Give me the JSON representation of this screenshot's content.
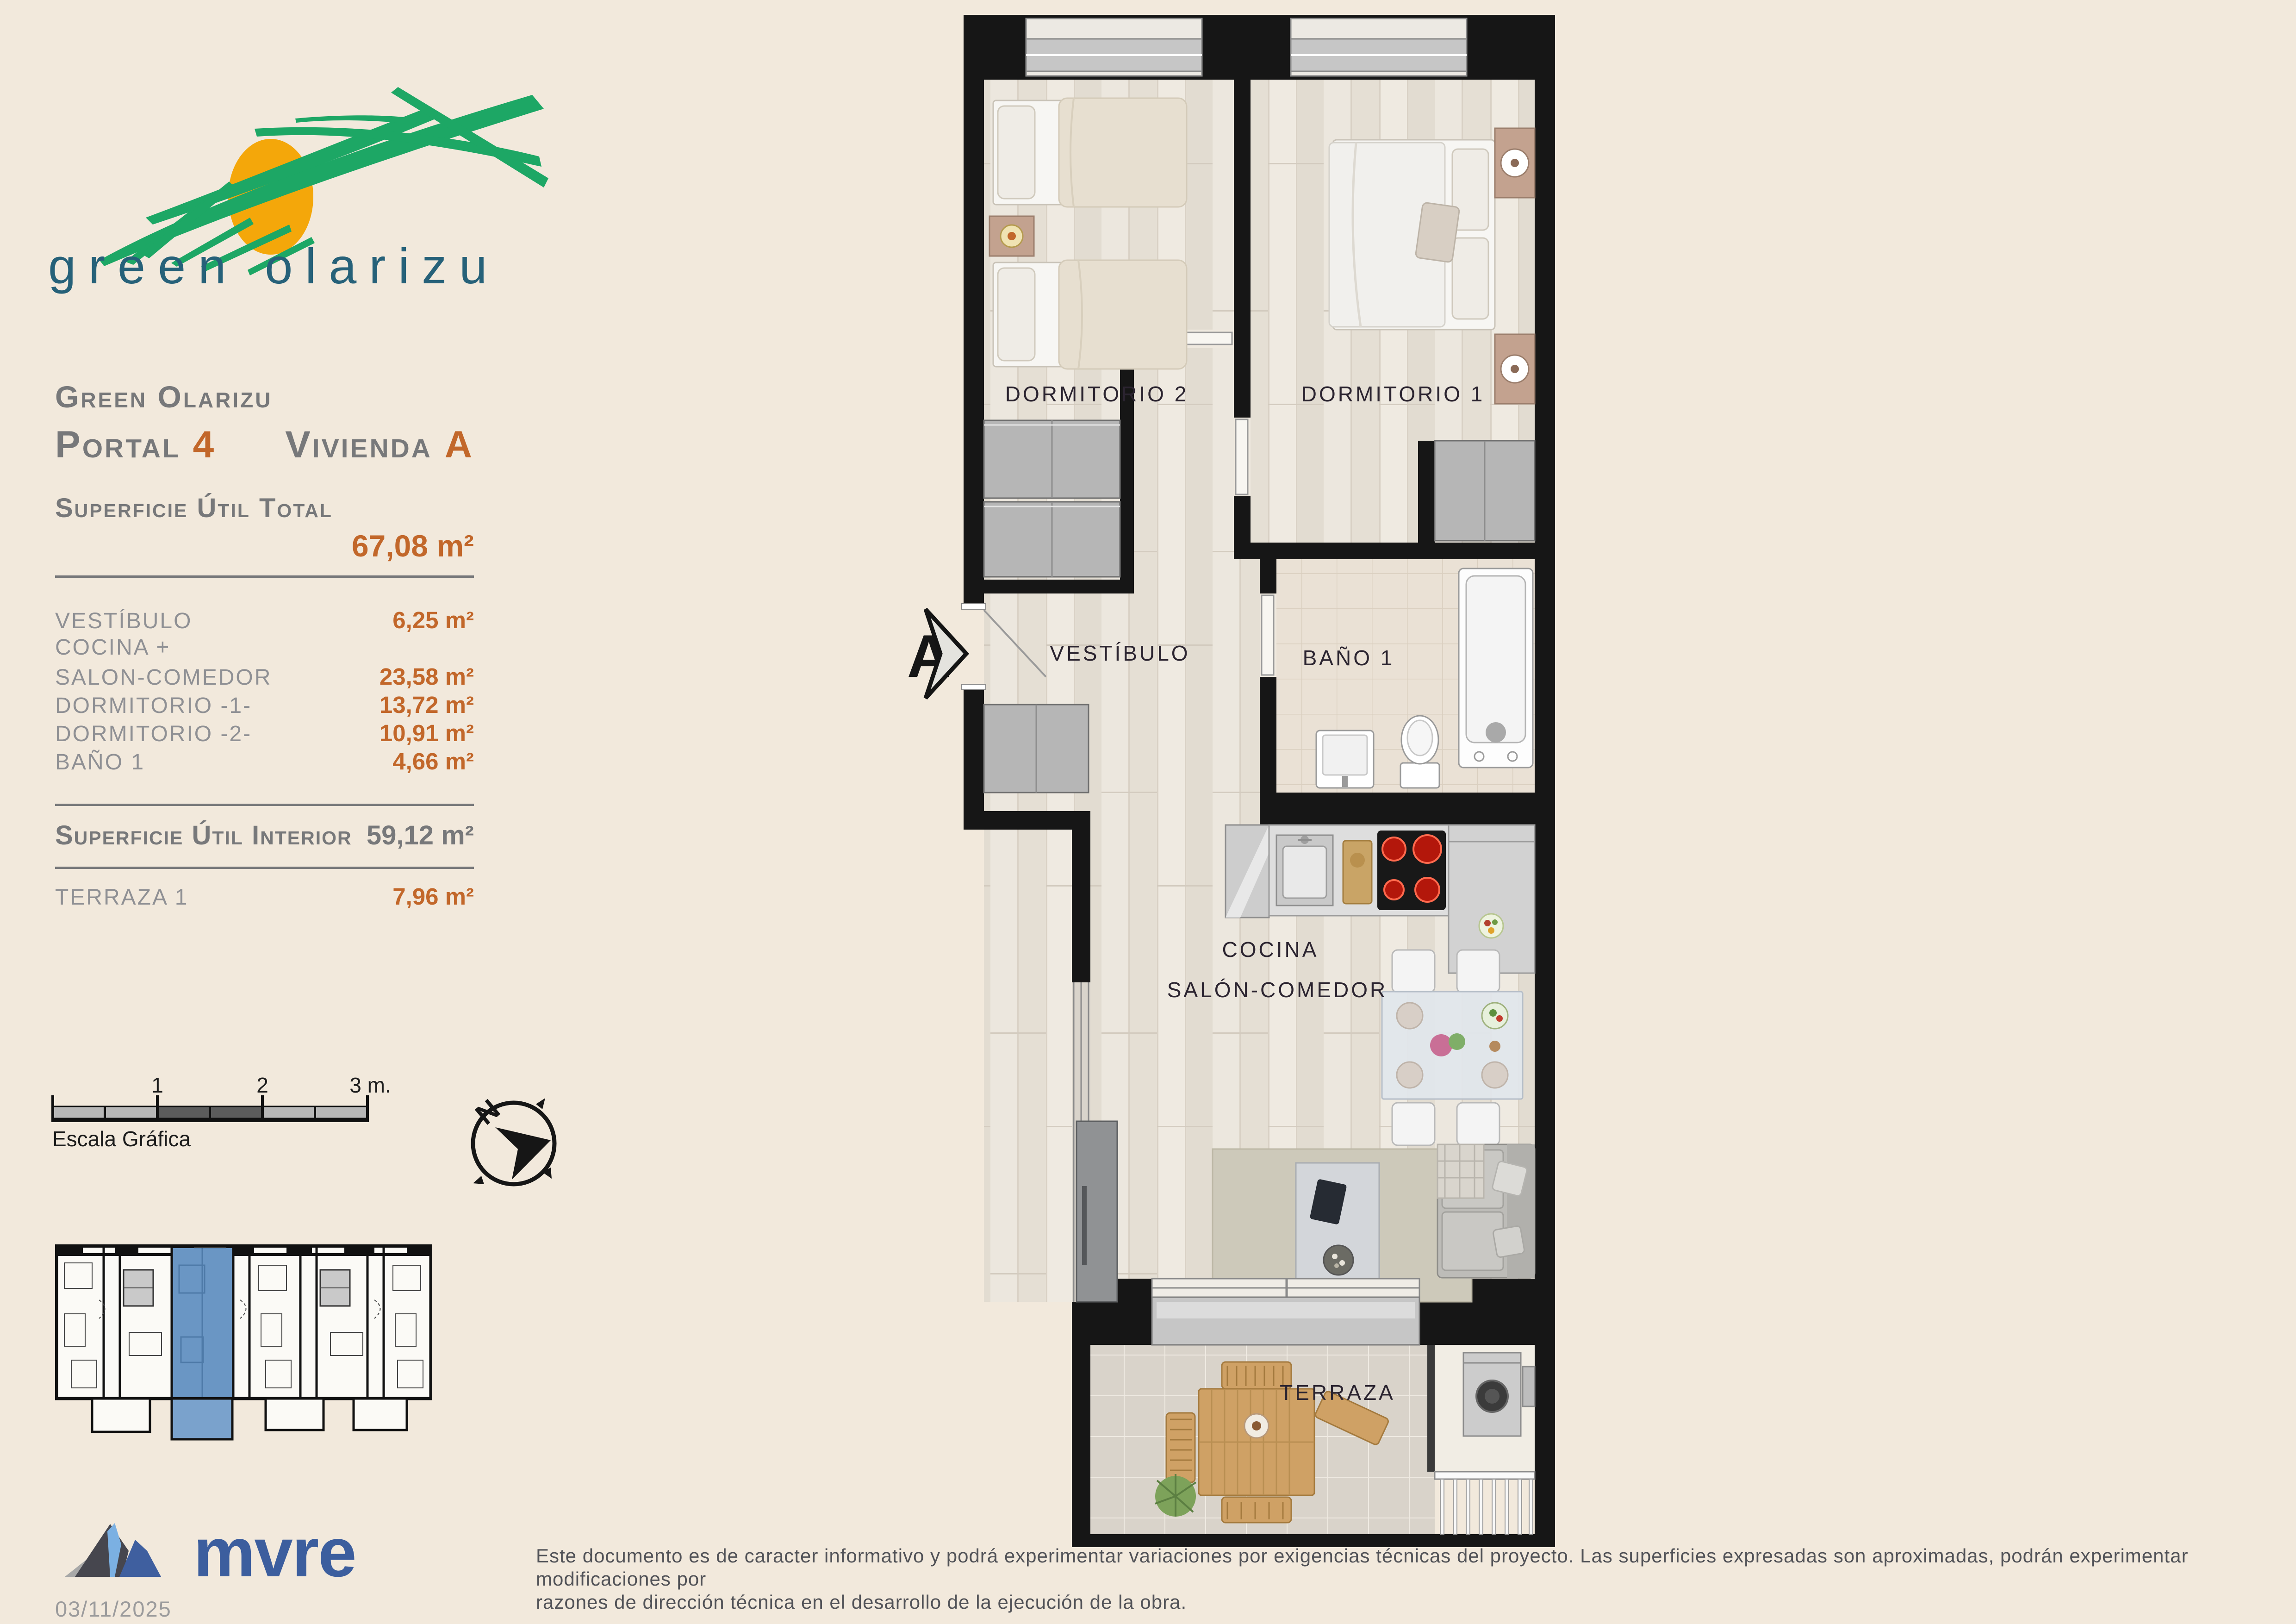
{
  "colors": {
    "background": "#f2e9dc",
    "accent_orange": "#c2672a",
    "heading_gray": "#77787a",
    "row_gray": "#8f9094",
    "logo_green": "#1da765",
    "logo_sun": "#f4a70a",
    "logo_teal": "#266179",
    "mvre_blue": "#3c5e9e",
    "keyplan_highlight": "#6a96c4",
    "wall_black": "#161616"
  },
  "logo": {
    "wordmark": "green olarizu"
  },
  "panel": {
    "title": "Green Olarizu",
    "portal_label": "Portal",
    "portal_value": "4",
    "vivienda_label": "Vivienda",
    "vivienda_value": "A",
    "total_label": "Superficie Útil Total",
    "total_value": "67,08 m²",
    "rows": [
      {
        "label": "VESTÍBULO",
        "value": "6,25 m²"
      },
      {
        "label": "COCINA +",
        "value": ""
      },
      {
        "label": "SALON-COMEDOR",
        "value": "23,58 m²"
      },
      {
        "label": "DORMITORIO -1-",
        "value": "13,72 m²"
      },
      {
        "label": "DORMITORIO -2-",
        "value": "10,91 m²"
      },
      {
        "label": "BAÑO 1",
        "value": "4,66 m²"
      }
    ],
    "interior_label": "Superficie Útil Interior",
    "interior_value": "59,12 m²",
    "terraza_label": "TERRAZA 1",
    "terraza_value": "7,96 m²"
  },
  "scalebar": {
    "title": "Escala Gráfica",
    "ticks": [
      "1",
      "2",
      "3 m."
    ]
  },
  "compass": {
    "north": "N"
  },
  "plan": {
    "section_marker": "A",
    "rooms": {
      "dorm2": "DORMITORIO 2",
      "dorm1": "DORMITORIO 1",
      "vestibulo": "VESTÍBULO",
      "bano": "BAÑO 1",
      "cocina": "COCINA",
      "salon": "SALÓN-COMEDOR",
      "terraza": "TERRAZA"
    }
  },
  "footer": {
    "brand": "mvre",
    "date": "03/11/2025",
    "disclaimer_line1": "Este documento es de caracter informativo y podrá experimentar variaciones por exigencias técnicas del proyecto. Las superficies expresadas son aproximadas, podrán experimentar modificaciones por",
    "disclaimer_line2": "razones de dirección técnica en el desarrollo de la ejecución de la obra."
  }
}
